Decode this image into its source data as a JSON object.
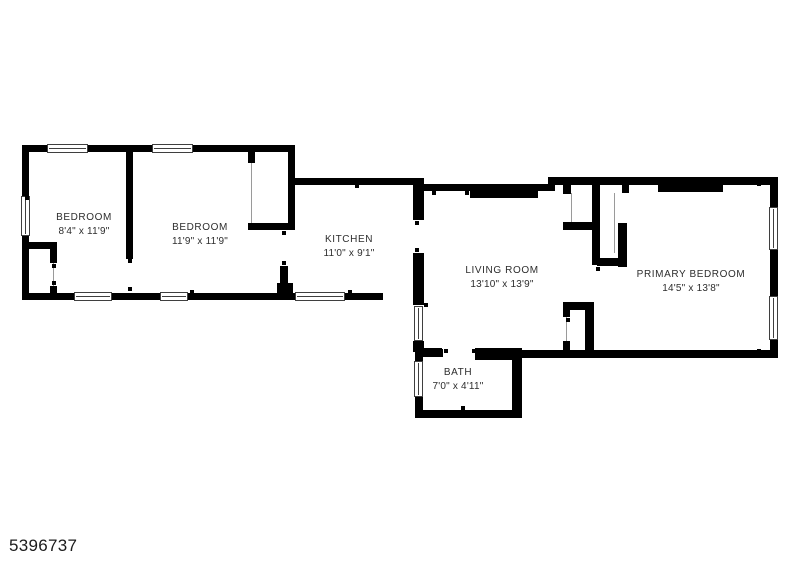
{
  "plan_id": "5396737",
  "rooms": [
    {
      "name": "BEDROOM",
      "dims": "8'4\" x 11'9\""
    },
    {
      "name": "BEDROOM",
      "dims": "11'9\" x 11'9\""
    },
    {
      "name": "KITCHEN",
      "dims": "11'0\" x 9'1\""
    },
    {
      "name": "LIVING ROOM",
      "dims": "13'10\" x 13'9\""
    },
    {
      "name": "PRIMARY BEDROOM",
      "dims": "14'5\" x 13'8\""
    },
    {
      "name": "BATH",
      "dims": "7'0\" x 4'11\""
    }
  ],
  "colors": {
    "wall": "#000000",
    "text": "#2d2d2d",
    "background": "#ffffff"
  }
}
